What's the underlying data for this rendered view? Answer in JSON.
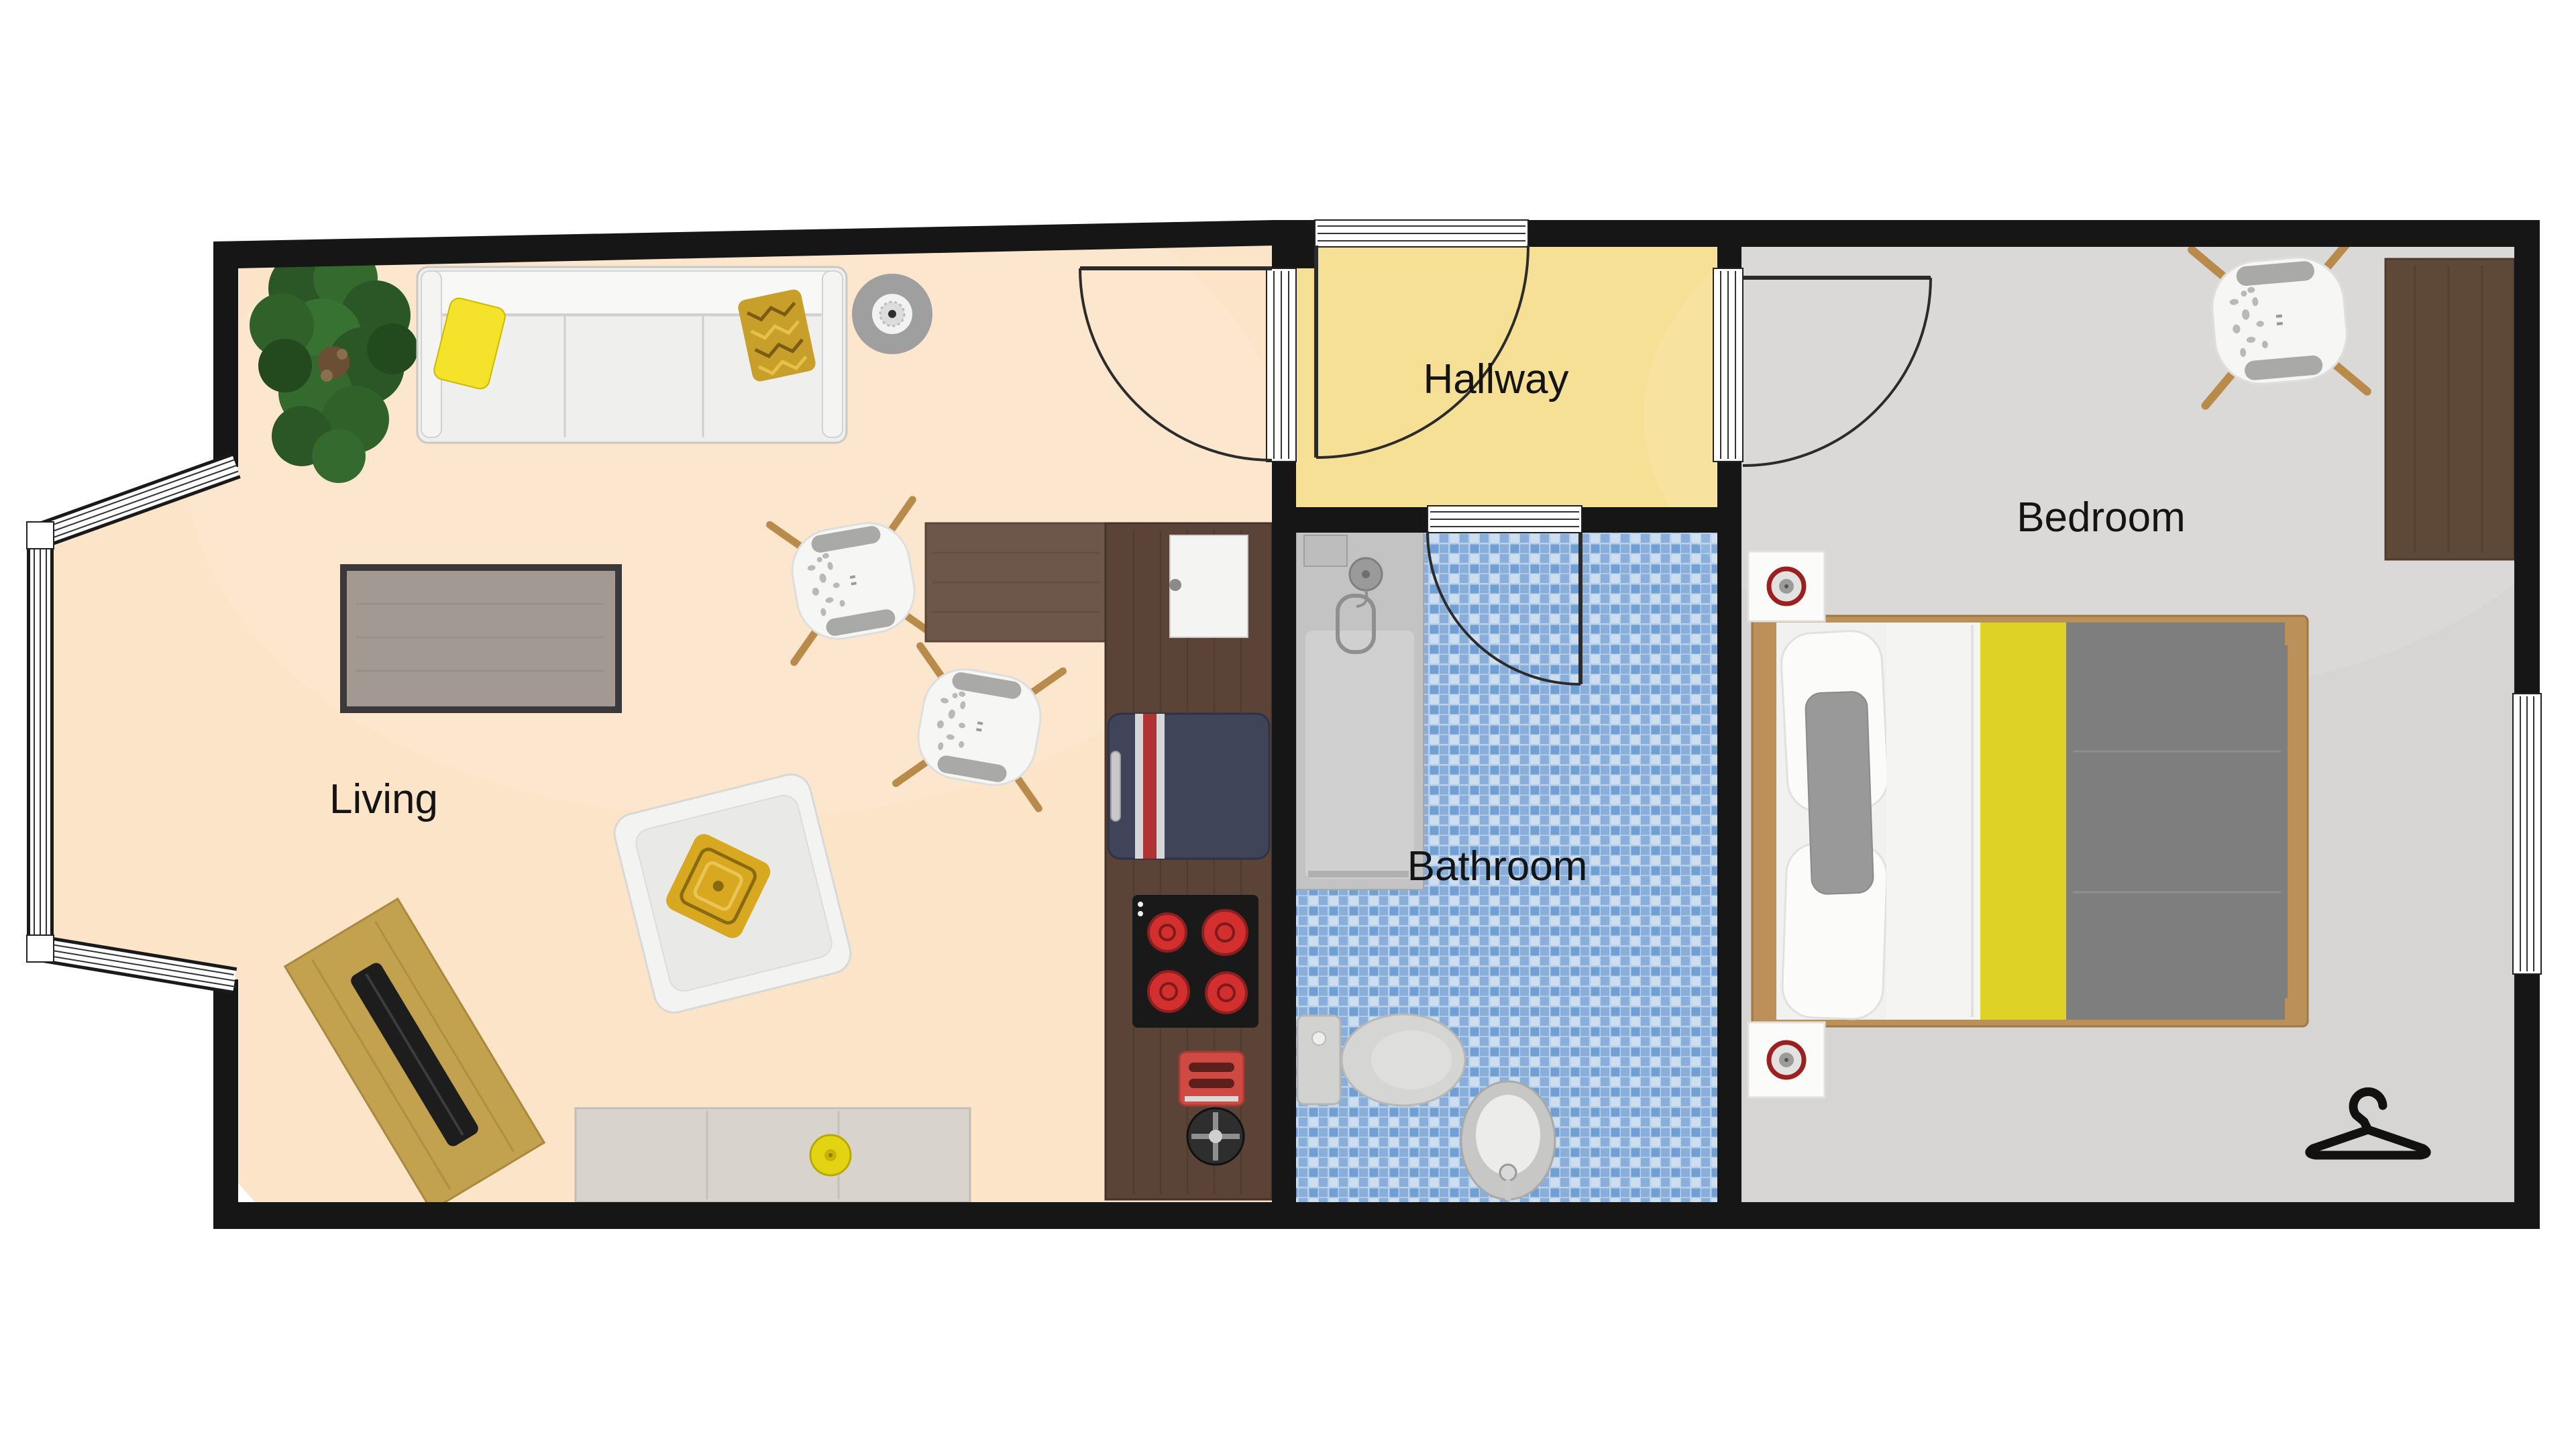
{
  "plan": {
    "type": "apartment-floor-plan",
    "rooms": {
      "living": {
        "label": "Living",
        "floor_color": "#fce4c8"
      },
      "hallway": {
        "label": "Hallway",
        "floor_color": "#f6e095"
      },
      "bathroom": {
        "label": "Bathroom",
        "tile_base": "#bcd0e8",
        "tile_dark": "#6f9fd3",
        "tile_mid": "#88aed9",
        "tile_light": "#cddeef"
      },
      "bedroom": {
        "label": "Bedroom",
        "floor_color": "#d6d5d3"
      }
    }
  },
  "colors": {
    "wall": "#161616",
    "counter_wood": "#5b4437",
    "dining_table_wood": "#6d564a",
    "desk_wood_living": "#c2a14f",
    "desk_wood_bedroom": "#5e4837",
    "laptop_black": "#1d1d1d",
    "sofa_white": "#efefed",
    "pillow_yellow": "#f4e32a",
    "pillow_chevron_gold": "#c99f2b",
    "armchair_pillow_gold": "#d8a820",
    "plant_green": "#2d5b28",
    "coffee_table_top": "#a29a92",
    "coffee_table_border": "#3a3a3a",
    "sideboard_gray": "#d8d4cd",
    "bowl_yellow": "#e3d413",
    "fridge_navy": "#3f4458",
    "fridge_stripe_red": "#b03434",
    "stove_black": "#191919",
    "burner_red": "#d32f2f",
    "bed_wood": "#bb9059",
    "bed_sheet_white": "#f4f4f2",
    "bed_stripe_yellow": "#ddd225",
    "bed_duvet_gray": "#7e7e7e",
    "bed_pillow_gray": "#999999",
    "nightstand_white": "#fbfbfa",
    "ring_red": "#9c2020",
    "shower_gray": "#c3c3c3",
    "fixture_gray": "#d5d5d3",
    "hanger_black": "#111111"
  }
}
